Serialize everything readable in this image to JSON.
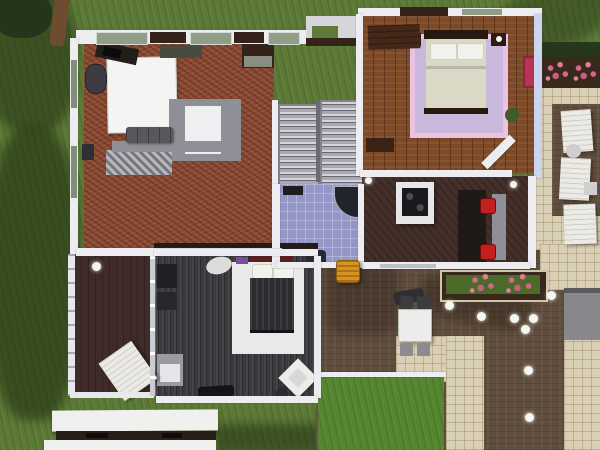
{
  "scene": {
    "title": "Top-down dollhouse view of a modern two-story home with wrap-around deck",
    "rooms": [
      "living-room",
      "master-bedroom",
      "bathroom",
      "stair-hall",
      "kitchen-diner",
      "guest-bedroom",
      "balcony",
      "pool-deck",
      "patio"
    ],
    "objects": [
      "projection-screen",
      "sectional-sofa",
      "tv-unit",
      "console-shelf",
      "telescope",
      "twin-staircase",
      "corner-shower",
      "toilet",
      "double-bed",
      "lavender-rug",
      "nightstand",
      "dresser",
      "wall-art",
      "kitchen-island",
      "stove",
      "dining-bar",
      "bar-stool",
      "guest-bed",
      "white-rug",
      "vanity-sink",
      "armchair",
      "wardrobe",
      "sun-lounger",
      "patio-table",
      "patio-chair",
      "grill",
      "flower-planter",
      "hedge",
      "garden-light",
      "orange-barrel",
      "white-plank-awning"
    ],
    "garden_lights_count": 9,
    "sun_loungers_count": 4,
    "bar_stools_count": 2
  },
  "palette": {
    "grass": "#5c7a36",
    "grass_bright": "#55852f",
    "tree_foliage": "#23361b",
    "tree_trunk": "#6e4c2f",
    "carpet": "#8a4a33",
    "wood": "#7d4a28",
    "kitchen_floor": "#443029",
    "charcoal_floor": "#3b3b3f",
    "balcony_floor": "#3f2b27",
    "deck": "#5f4d3d",
    "cream": "#d9cfb5",
    "bath_tile": "#9496c7",
    "stair": "#a9a9b2",
    "wall": "#ededf1",
    "wall_lavender": "#cdd4ef",
    "glass": "#8f9e85",
    "glass_cool": "#b9c3c6",
    "glass_left": "#7f8d7a",
    "dark_wall": "#33231a",
    "landing": "#d6d6da",
    "panel_green": "#5f7a38",
    "screen": "#f4f4f2",
    "sofa": "#57575d",
    "atrium_frame": "#8f8f97",
    "atrium_inner": "#edeff0",
    "tv": "#241e1a",
    "shelf": "#8a8d84",
    "console": "#474b40",
    "telescope": "#3c3c42",
    "rug_lavender": "#c9b8dc",
    "rug_glow": "#e9c4e2",
    "bed_frame": "#26190f",
    "mattress": "#dcd8c6",
    "pillow": "#f1f2ec",
    "nightstand": "#2a1c12",
    "dresser": "#46281a",
    "art_pink": "#b93355",
    "plant_green": "#3f5b2b",
    "island": "#e6e6e6",
    "stove": "#1a1a1e",
    "table_dark": "#1f1a16",
    "counter_gray": "#8f9097",
    "stool_red": "#c41f1f",
    "planter_soil": "#38291c",
    "planter_grass": "#4c6b2a",
    "hedge": "#26371c",
    "lounger": "#eceae4",
    "side_table": "#cfcfd2",
    "railing": "#e8e8ec",
    "rug_white": "#e9e9ea",
    "head_red": "#5a1f1f",
    "blanket": "#2b2b30",
    "vanity": "#dcdcda",
    "decor_purple": "#7a4f9a",
    "dark_unit": "#1f1f24",
    "cabinet_gray": "#9a9aa0",
    "chair_white": "#ececea",
    "clutter": "#141416",
    "table_white": "#ececea",
    "chair_dark": "#3c3c40",
    "chair_gray": "#8b8b90",
    "grill": "#2e2e33",
    "roof_gray": "#87878c",
    "light": "#f6f6f2",
    "barrel_orange": "#d8921e",
    "plank_white": "#f0f0ee",
    "dark_strip": "#262019"
  }
}
